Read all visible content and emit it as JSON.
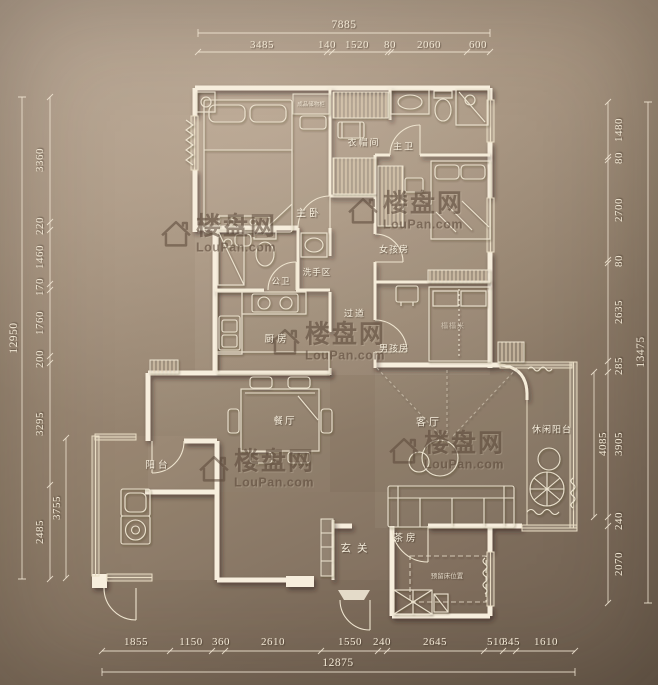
{
  "watermark": {
    "brand": "楼盘网",
    "domain": "LouPan.com"
  },
  "rooms": {
    "master_bedroom": "主卧",
    "cloakroom": "衣帽间",
    "master_bath": "主卫",
    "girl_room": "女孩房",
    "wash_area": "洗手区",
    "guest_bath": "公卫",
    "corridor": "过道",
    "kitchen": "厨房",
    "boy_room": "男孩房",
    "tatami": "榻榻米",
    "dining": "餐厅",
    "living": "客厅",
    "leisure_balcony": "休闲阳台",
    "balcony": "阳台",
    "foyer": "玄关",
    "tea_room": "茶房",
    "reserved_bed": "预留床位置",
    "storage_cabinet": "成品储物柜"
  },
  "dimensions": {
    "top": {
      "total": "7885",
      "segments": [
        "3485",
        "140",
        "1520",
        "80",
        "2060",
        "600"
      ]
    },
    "bottom": {
      "total": "12875",
      "segments": [
        "1855",
        "1150",
        "360",
        "2610",
        "1550",
        "240",
        "2645",
        "510",
        "345",
        "1610"
      ]
    },
    "left": {
      "total": "12950",
      "inner": "3755",
      "segments": [
        "3360",
        "220",
        "1460",
        "170",
        "1760",
        "200",
        "3295",
        "2485"
      ]
    },
    "right": {
      "total": "13475",
      "inner": "4085",
      "segments": [
        "1480",
        "80",
        "2700",
        "80",
        "2635",
        "285",
        "3905",
        "240",
        "2070"
      ]
    }
  }
}
